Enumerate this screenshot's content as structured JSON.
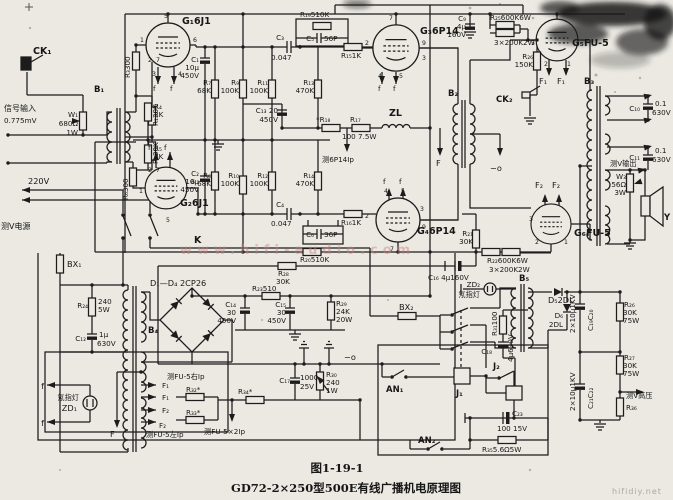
{
  "figure": {
    "number": "图1-19-1",
    "caption": "GD72-2×250型500E有线广播机电原理图"
  },
  "colors": {
    "background": "#ebe9e2",
    "line": "#1c1c1c",
    "smudge": "#181818",
    "watermark_pink": "#c98080",
    "watermark_gray": "#a9a9a9"
  },
  "labels": {
    "ck1": "CK₁",
    "sig1": "信号输入",
    "sig2": "0.775mV",
    "w1": "W₁",
    "w1v": "680Ω",
    "w1w": "1W",
    "b1": "B₁",
    "r1": "R₁30K",
    "r2": "R₂30K",
    "r3": "R₃300",
    "r6": "R₆300",
    "g1": "G₁6J1",
    "g2": "G₂6J1",
    "c1": "C₁",
    "c1v": "10μ",
    "c1w": "450V",
    "c2": "C₂",
    "c2v": "10μ",
    "c2w": "450V",
    "r4": "R₄",
    "r4v": "2K",
    "r5": "R₅",
    "r5v": "2K",
    "r7": "R₇",
    "r7v": "68K",
    "r8": "R₈",
    "r8v": "68K",
    "r9": "R₉",
    "r9v": "100K",
    "r10": "R₁₀",
    "r10v": "100K",
    "r11": "R₁₁",
    "r11v": "100K",
    "r12": "R₁₂",
    "r12v": "100K",
    "r13": "R₁₃",
    "r13v": "470K",
    "r14": "R₁₄",
    "r14v": "470K",
    "c3": "C₃",
    "c3v": "0.047",
    "c4": "C₄",
    "c4v": "0.047",
    "r19": "R₁₉510K",
    "c5": "C₅",
    "c5v": "56P",
    "r20": "R₂₀510K",
    "c6": "C₆",
    "c6v": "36P",
    "r15": "R₁₅1K",
    "r16": "R₁₆1K",
    "g3": "G₃6P14",
    "g4": "G₄6P14",
    "c13": "C₁₃ 20",
    "c13v": "450V",
    "r18": "*R₁₈",
    "r17": "R₁₇",
    "r17v": "100 7.5W",
    "zl": "ZL",
    "m6p14": "测6P14Ip",
    "fmid": "F",
    "c9": "C₉",
    "c9v": "4μ",
    "c9w": "160V",
    "r25": "R₂₅600K6W",
    "r25v": "3×200K2W",
    "g5": "G₅FU-5",
    "r26": "R₂₆",
    "r26v": "150K",
    "ck2": "CK₂",
    "b2": "B₂",
    "f1a": "F₁",
    "f1b": "F₁",
    "f2a": "F₂",
    "f2b": "F₂",
    "mo1": "−o",
    "mo2": "−o",
    "b3": "B₃",
    "c10": "C₁₀",
    "c10v": "0.1",
    "c10w": "630V",
    "c11": "C₁₁",
    "c11v": "0.1",
    "c11w": "630V",
    "mvout": "测V输出",
    "w3": "W₃",
    "w3v": "56Ω",
    "w3w": "3W",
    "spk": "Y",
    "g6": "G₆FU-5",
    "r21": "R₂₁",
    "r21v": "30K",
    "r22": "R₂₂600K6W",
    "r22v": "3×200K2W",
    "c16": "C₁₆ 4μ160V",
    "v220": "220V",
    "mvpow": "测V电源",
    "k": "K",
    "bx1": "BX₁",
    "bx2": "BX₂",
    "r24": "R₂₄",
    "r24v": "240",
    "r24w": "5W",
    "b4": "B₄",
    "c12": "C₁₂",
    "c12v": "1μ",
    "c12w": "630V",
    "d14": "D₁—D₄ 2CP26",
    "zd1": "ZD₁",
    "zd1n": "氖指灯",
    "zd2": "ZD₂",
    "zd2n": "氖指灯",
    "f": "f",
    "ff1a": "F₁",
    "ff1b": "F₁",
    "ff2a": "F₂",
    "ff2b": "F₂",
    "mfur": "测FU-5右Ip",
    "r32": "R₃₂*",
    "r33": "R₃₃*",
    "mful": "测FU-5左Ip",
    "fdn": "F",
    "c14": "C₁₄",
    "c14v": "30",
    "c14w": "450V",
    "c15": "C₁₅",
    "c15v": "30",
    "c15w": "450V",
    "r29": "R₂₉",
    "r29v": "24K",
    "r29w": "20W",
    "r23": "R₂₃510",
    "r28": "R₂₈",
    "r28v": "30K",
    "c17": "C₁₇",
    "c17v": "1000",
    "c17w": "25V",
    "r30": "R₃₀",
    "r30v": "240",
    "r30w": "1W",
    "r34": "R₃₄*",
    "mfu2": "测FU-5×2Ip",
    "an1": "AN₁",
    "an2": "AN₂",
    "j1": "J₁",
    "j2": "J₂",
    "b5": "B₅",
    "r31": "R₃₁100",
    "c18": "C₁₈",
    "c18v": "4μ630V",
    "c23": "C₂₃",
    "c23v": "100 15V",
    "r35": "R₃₅5.6Ω5W",
    "d5": "D₅2DL",
    "d6": "D₆",
    "d6v": "2DL",
    "c1920": "C₁₉C₂₀",
    "hv1": "2×10μ1KV",
    "hv2": "2×10μ1KV",
    "c2122": "C₂₁C₂₂",
    "r26b": "R₂₆",
    "r26bv": "30K",
    "r26bw": "75W",
    "r27": "R₂₇",
    "r27v": "30K",
    "r27w": "75W",
    "mvhv": "测V高压",
    "r36": "R₃₆",
    "fig": "图1-19-1",
    "caption": "GD72-2×250型500E有线广播机电原理图",
    "wm1": "www.hifi-audio.com",
    "wm2": "hifidiy.net"
  },
  "pins": {
    "g1": [
      "1",
      "5",
      "6",
      "2",
      "7",
      "3",
      "4"
    ],
    "g2": [
      "2",
      "7",
      "1",
      "6",
      "5"
    ],
    "g3": [
      "7",
      "9",
      "2",
      "3",
      "4",
      "5"
    ],
    "g4": [
      "2",
      "4",
      "5",
      "3",
      "9",
      "7"
    ],
    "g5": [
      "3",
      "2",
      "1"
    ],
    "g6": [
      "3",
      "2",
      "1"
    ]
  }
}
